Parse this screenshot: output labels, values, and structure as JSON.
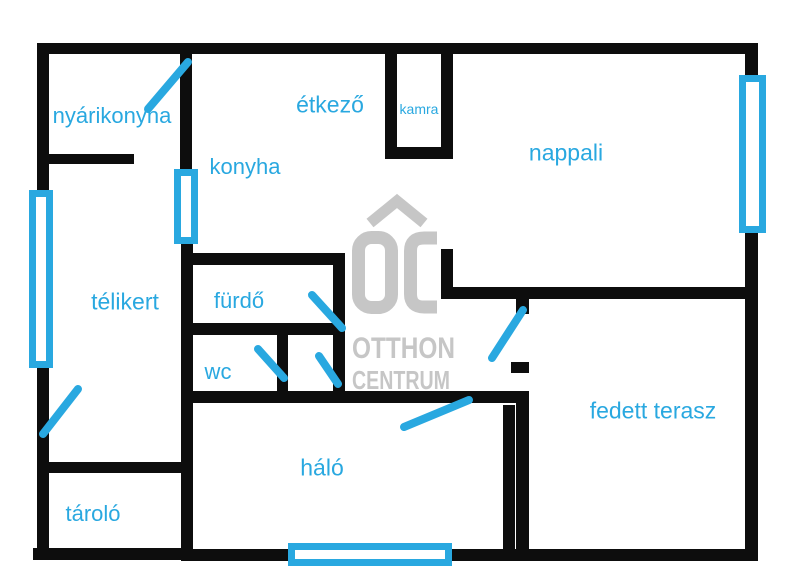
{
  "title": "floor-plan",
  "colors": {
    "accent": "#29A8E0",
    "wall": "#0D0D0D",
    "watermark": "#C6C6C6",
    "background": "#FFFFFF"
  },
  "watermark": {
    "brand_initials": "OC",
    "line1": "OTTHON",
    "line2": "CENTRUM"
  },
  "rooms": {
    "nyarikonyha": {
      "label": "nyárikonyha"
    },
    "etkezo": {
      "label": "étkező"
    },
    "kamra": {
      "label": "kamra"
    },
    "nappali": {
      "label": "nappali"
    },
    "konyha": {
      "label": "konyha"
    },
    "telikert": {
      "label": "télikert"
    },
    "furdo": {
      "label": "fürdő"
    },
    "wc": {
      "label": "wc"
    },
    "halo": {
      "label": "háló"
    },
    "fedett_terasz": {
      "label": "fedett terasz"
    },
    "tarolo": {
      "label": "tároló"
    }
  }
}
